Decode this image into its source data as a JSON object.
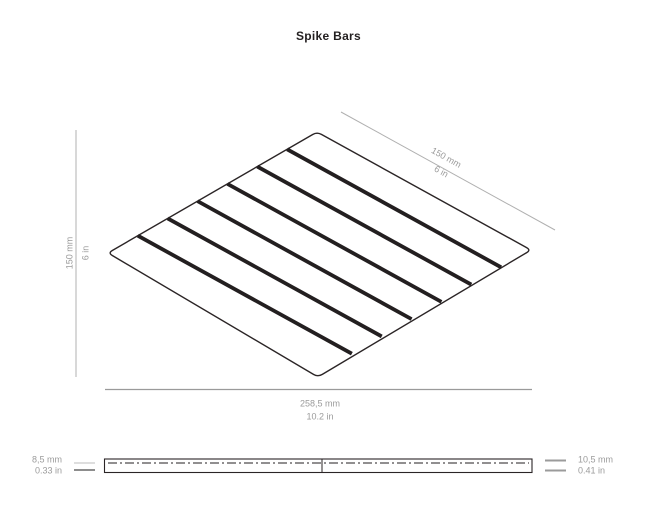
{
  "title": "Spike Bars",
  "views": {
    "isometric": {
      "bar_count": 6,
      "top_right_dim": {
        "metric": "150 mm",
        "imperial": "6 in"
      },
      "left_dim": {
        "metric": "150 mm",
        "imperial": "6 in"
      },
      "bottom_dim": {
        "metric": "258,5 mm",
        "imperial": "10.2 in"
      }
    },
    "profile": {
      "left_thickness": {
        "metric": "8,5 mm",
        "imperial": "0.33 in"
      },
      "right_thickness": {
        "metric": "10,5 mm",
        "imperial": "0.41 in"
      }
    }
  },
  "colors": {
    "ink": "#231f20",
    "outline": "#2b2526",
    "dimension_line": "#b0b0b0",
    "dimension_text": "#9b9b9b"
  }
}
